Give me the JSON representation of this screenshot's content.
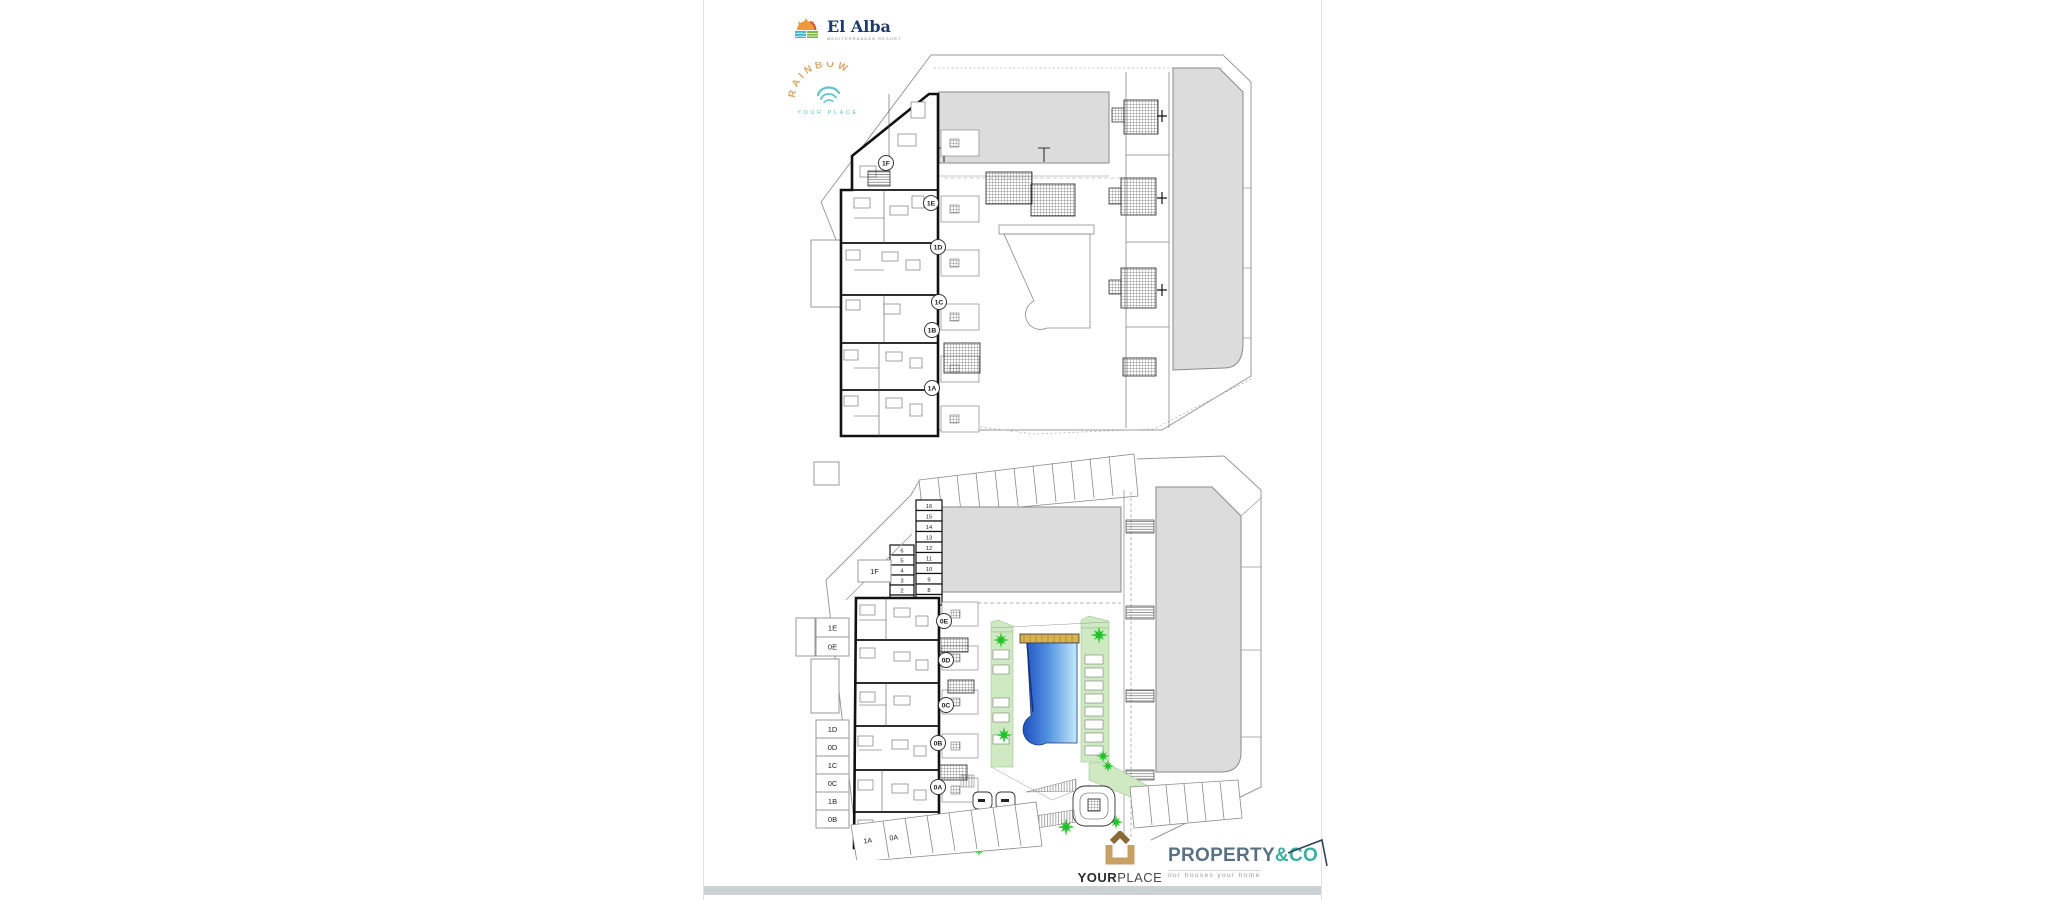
{
  "document": {
    "header": {
      "el_alba": {
        "name": "El Alba",
        "tagline": "MEDITERRANEAN RESORT"
      },
      "rainbow": {
        "name": "RAINBOW",
        "tagline": "YOUR PLACE"
      }
    },
    "footer": {
      "yourplace": {
        "name_bold": "YOUR",
        "name_light": "PLACE",
        "tagline": "REAL ESTATE"
      },
      "property_co": {
        "name": "PROPERTY",
        "suffix": "&CO",
        "tagline": "our houses your home"
      }
    },
    "upper_plan": {
      "units": [
        "1F",
        "1E",
        "1D",
        "1C",
        "1B",
        "1A"
      ]
    },
    "lower_plan": {
      "units": [
        "0E",
        "0D",
        "0C",
        "0B",
        "0A"
      ],
      "left_labels": [
        "1E",
        "0E",
        "1D",
        "0D",
        "1C",
        "0C",
        "1B",
        "0B"
      ],
      "area_label": "1F",
      "parking_labels": [
        "1A",
        "0A"
      ],
      "storage_right": [
        "16",
        "15",
        "14",
        "13",
        "12",
        "11",
        "10",
        "9",
        "8",
        "7"
      ],
      "storage_left": [
        "6",
        "5",
        "4",
        "3",
        "2",
        "1"
      ]
    },
    "colors": {
      "building_fill": "#dcdcdc",
      "pool_dark": "#1f4fc0",
      "pool_light": "#c2eafc",
      "green_area": "#cfe9c3",
      "plant_green": "#2fd12f",
      "deck_tan": "#d9b14d",
      "elalba_navy": "#1e3a6e",
      "rainbow_tan": "#d9a96b",
      "rainbow_teal": "#5fc3c9",
      "yourplace_gold": "#b89058",
      "property_slate": "#5a7184",
      "property_teal": "#3fae9f"
    }
  }
}
